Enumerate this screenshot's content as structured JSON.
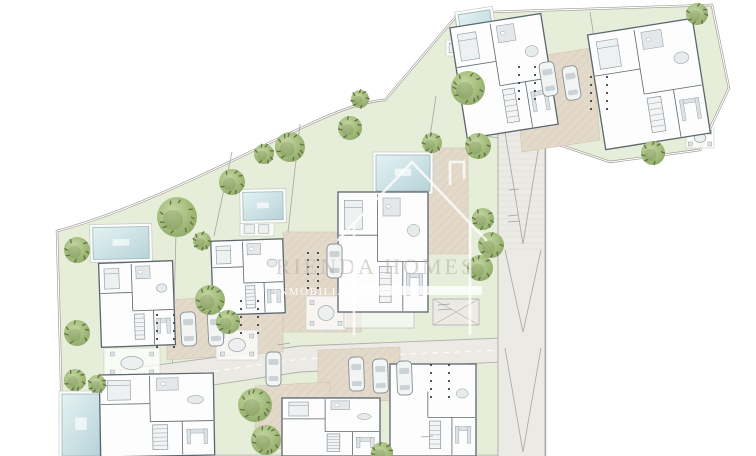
{
  "watermark": {
    "line1": "RIENDA HOMES",
    "line2": "INMOBILIARIA"
  },
  "colors": {
    "background": "#ffffff",
    "lawn": "#e6edd8",
    "boundary": "#9d9b95",
    "tree": "#a4bd7d",
    "tree_dark": "#53633e",
    "pool_edge": "#9db6ba",
    "wall": "#5c666f",
    "room": "#fcfdfc",
    "furniture": "#e4e8ea",
    "furniture_edge": "#8e979d",
    "road": "#eceae5",
    "road_edge": "#b2b0aa",
    "paving": "#e3d9ca",
    "paving_line": "#cfc3b0",
    "car": "#f3f4f4",
    "car_edge": "#878f95",
    "glass": "#ccd3d6",
    "dots": "#4b5157",
    "watermark_text": "#b3ada2",
    "watermark_white": "#ffffff"
  },
  "scene": {
    "outline": "M57,231 C150,206 245,152 330,115 C352,106 370,101 385,100 L459,13 L712,5 L729,88 L700,150 L610,162 L545,140 L545,456 L63,456 Z",
    "dividers": [
      "M176,232 L170,456",
      "M300,124 L288,232",
      "M232,152 L214,236",
      "M590,12 L596,50",
      "M455,15 L470,135 L545,142",
      "M436,96 L428,150"
    ],
    "main_road": "120,370 300,346 502,338 502,362 300,372 126,398",
    "road_dash": "126,384 300,359 500,350",
    "ramp": [
      498,
      112,
      47,
      344
    ],
    "chevrons": [
      "M505,250 L523,332 L541,250",
      "M505,348 L523,452 L541,348",
      "M503,120 L523,244 L543,120"
    ],
    "junction": [
      433,
      299,
      46,
      26
    ],
    "pavings": [
      "514,60 592,48 600,140 522,152",
      "428,148 468,148 468,254 428,254",
      "283,232 361,232 361,332 283,332",
      "167,300 283,293 283,352 167,360",
      "318,350 400,347 400,400 318,403",
      "255,386 330,382 330,446 255,450"
    ],
    "villas": [
      {
        "id": "a",
        "x": 458,
        "y": 20,
        "w": 92,
        "h": 112,
        "rot": -9
      },
      {
        "id": "b",
        "x": 596,
        "y": 26,
        "w": 106,
        "h": 116,
        "rot": -9
      },
      {
        "id": "c",
        "x": 338,
        "y": 192,
        "w": 90,
        "h": 120,
        "rot": 0,
        "terrace": true
      },
      {
        "id": "d",
        "x": 100,
        "y": 262,
        "w": 74,
        "h": 84,
        "rot": -2
      },
      {
        "id": "e",
        "x": 212,
        "y": 240,
        "w": 72,
        "h": 74,
        "rot": -2
      },
      {
        "id": "h",
        "x": 100,
        "y": 374,
        "w": 114,
        "h": 82,
        "rot": -1
      },
      {
        "id": "i",
        "x": 282,
        "y": 398,
        "w": 98,
        "h": 58,
        "rot": 0
      },
      {
        "id": "j",
        "x": 390,
        "y": 364,
        "w": 86,
        "h": 92,
        "rot": 0,
        "openTop": true
      }
    ],
    "pools": [
      [
        461,
        12,
        32,
        40,
        -9
      ],
      [
        660,
        60,
        32,
        46,
        -9
      ],
      [
        376,
        155,
        54,
        36,
        0
      ],
      [
        243,
        192,
        40,
        28,
        -1
      ],
      [
        93,
        227,
        56,
        32,
        -1
      ],
      [
        62,
        394,
        38,
        62,
        0
      ],
      [
        329,
        446,
        34,
        10,
        0
      ],
      [
        412,
        446,
        38,
        10,
        0
      ]
    ],
    "patios": [
      [
        104,
        348,
        56,
        30
      ],
      [
        306,
        296,
        40,
        34
      ],
      [
        216,
        330,
        42,
        30
      ],
      [
        444,
        366,
        34,
        30
      ],
      [
        686,
        128,
        28,
        20
      ],
      [
        446,
        40,
        26,
        16
      ],
      [
        240,
        222,
        34,
        14
      ]
    ],
    "cars": [
      [
        181,
        312,
        -3
      ],
      [
        208,
        312,
        -3
      ],
      [
        327,
        244,
        0
      ],
      [
        266,
        352,
        0
      ],
      [
        349,
        357,
        -2
      ],
      [
        373,
        359,
        -2
      ],
      [
        397,
        361,
        -2
      ],
      [
        541,
        62,
        -9
      ],
      [
        564,
        66,
        -9
      ]
    ],
    "dot_grids": [
      [
        307,
        252,
        6,
        2,
        10,
        7
      ],
      [
        156,
        314,
        5,
        2,
        17,
        8
      ],
      [
        240,
        300,
        5,
        2,
        17,
        8
      ],
      [
        430,
        364,
        5,
        2,
        18,
        8
      ],
      [
        518,
        66,
        5,
        2,
        16,
        8
      ],
      [
        590,
        76,
        5,
        2,
        16,
        8
      ]
    ],
    "trees": [
      [
        697,
        14,
        11
      ],
      [
        468,
        88,
        17
      ],
      [
        478,
        146,
        13
      ],
      [
        432,
        143,
        10
      ],
      [
        360,
        99,
        9
      ],
      [
        350,
        128,
        12
      ],
      [
        290,
        147,
        15
      ],
      [
        264,
        154,
        10
      ],
      [
        232,
        182,
        13
      ],
      [
        177,
        217,
        20
      ],
      [
        77,
        250,
        13
      ],
      [
        202,
        241,
        9
      ],
      [
        210,
        300,
        15
      ],
      [
        228,
        322,
        12
      ],
      [
        77,
        333,
        13
      ],
      [
        255,
        405,
        17
      ],
      [
        266,
        440,
        15
      ],
      [
        75,
        380,
        11
      ],
      [
        97,
        384,
        9
      ],
      [
        483,
        219,
        11
      ],
      [
        491,
        245,
        13
      ],
      [
        480,
        268,
        13
      ],
      [
        653,
        153,
        12
      ],
      [
        382,
        453,
        11
      ]
    ],
    "ticks": [
      [
        508,
        216,
        518,
        215
      ],
      [
        508,
        222,
        520,
        221
      ],
      [
        438,
        305,
        450,
        304
      ],
      [
        438,
        310,
        452,
        309
      ],
      [
        278,
        345,
        290,
        343
      ],
      [
        421,
        437,
        433,
        436
      ],
      [
        509,
        190,
        519,
        189
      ]
    ]
  }
}
